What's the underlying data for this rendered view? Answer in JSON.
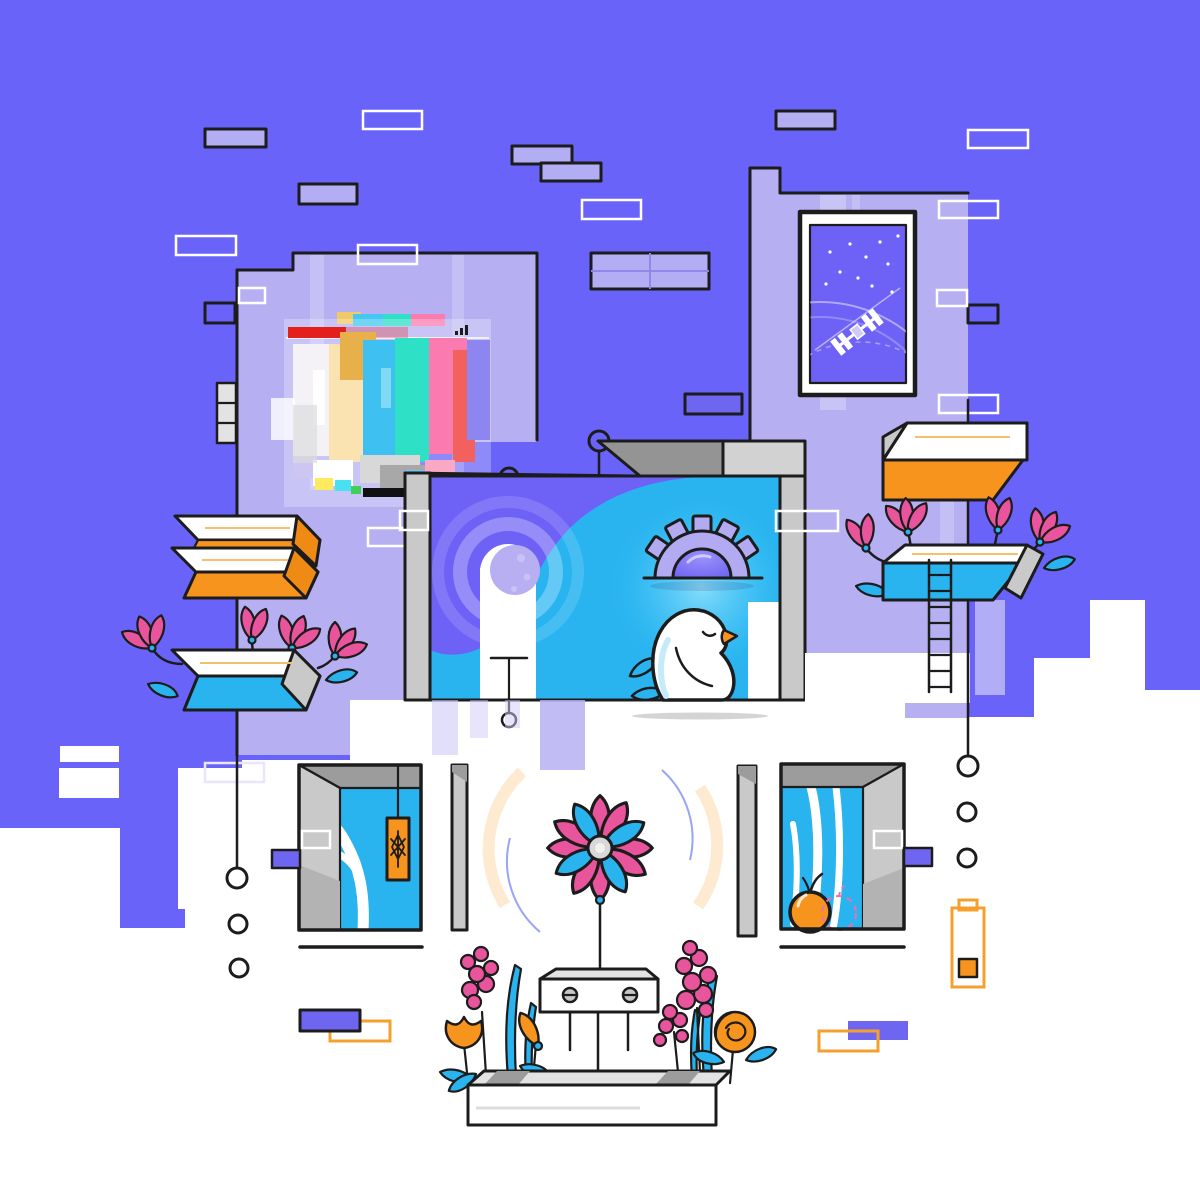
{
  "illustration": {
    "kind": "abstract flat vector illustration",
    "text_content": [],
    "palette": {
      "ink": "#1c1c1c",
      "bg": "#6a63f9",
      "lavender": "#b6b0f2",
      "lav-light": "#cbc6f8",
      "rect": "#b3aef3",
      "accent": "#6e66f1",
      "panel": "#6e62f6",
      "cyan": "#29b4f0",
      "cyan-bright": "#6fd4fa",
      "orange": "#f7941d",
      "orange-soft": "#f5a02c",
      "orange-dark": "#ef8a15",
      "pink": "#e8559d",
      "red": "#e3201b",
      "white": "#ffffff",
      "gray-light": "#e3e3e3",
      "gray-mid": "#c9c9c9",
      "gray-dark": "#9c9c9c",
      "moon-light": "#dcd8fa",
      "moon-dark": "#b7aff2",
      "gear": "#b2abf2"
    },
    "objects": [
      "stepped-purple-skyline-background",
      "lavender-buildings",
      "scattered-glitch-rectangles",
      "corrupted-glitch-browser-window",
      "space-window-with-satellite-and-stars",
      "wave-panel-with-moon-and-gear-sunrise",
      "sleeping-white-bird",
      "floating-orange-shelves",
      "floating-blue-shelves-with-magnolia-flowers",
      "ladder",
      "hanging-connector-circles",
      "left-door-with-branch-and-orange-tag",
      "right-door-with-branches-and-apple",
      "pink-blue-pinwheel-flower",
      "robot-box-sprinkler",
      "flower-planter-with-tulips-hyacinths",
      "low-battery-icon",
      "purple-orange-rectangle-pairs"
    ]
  }
}
